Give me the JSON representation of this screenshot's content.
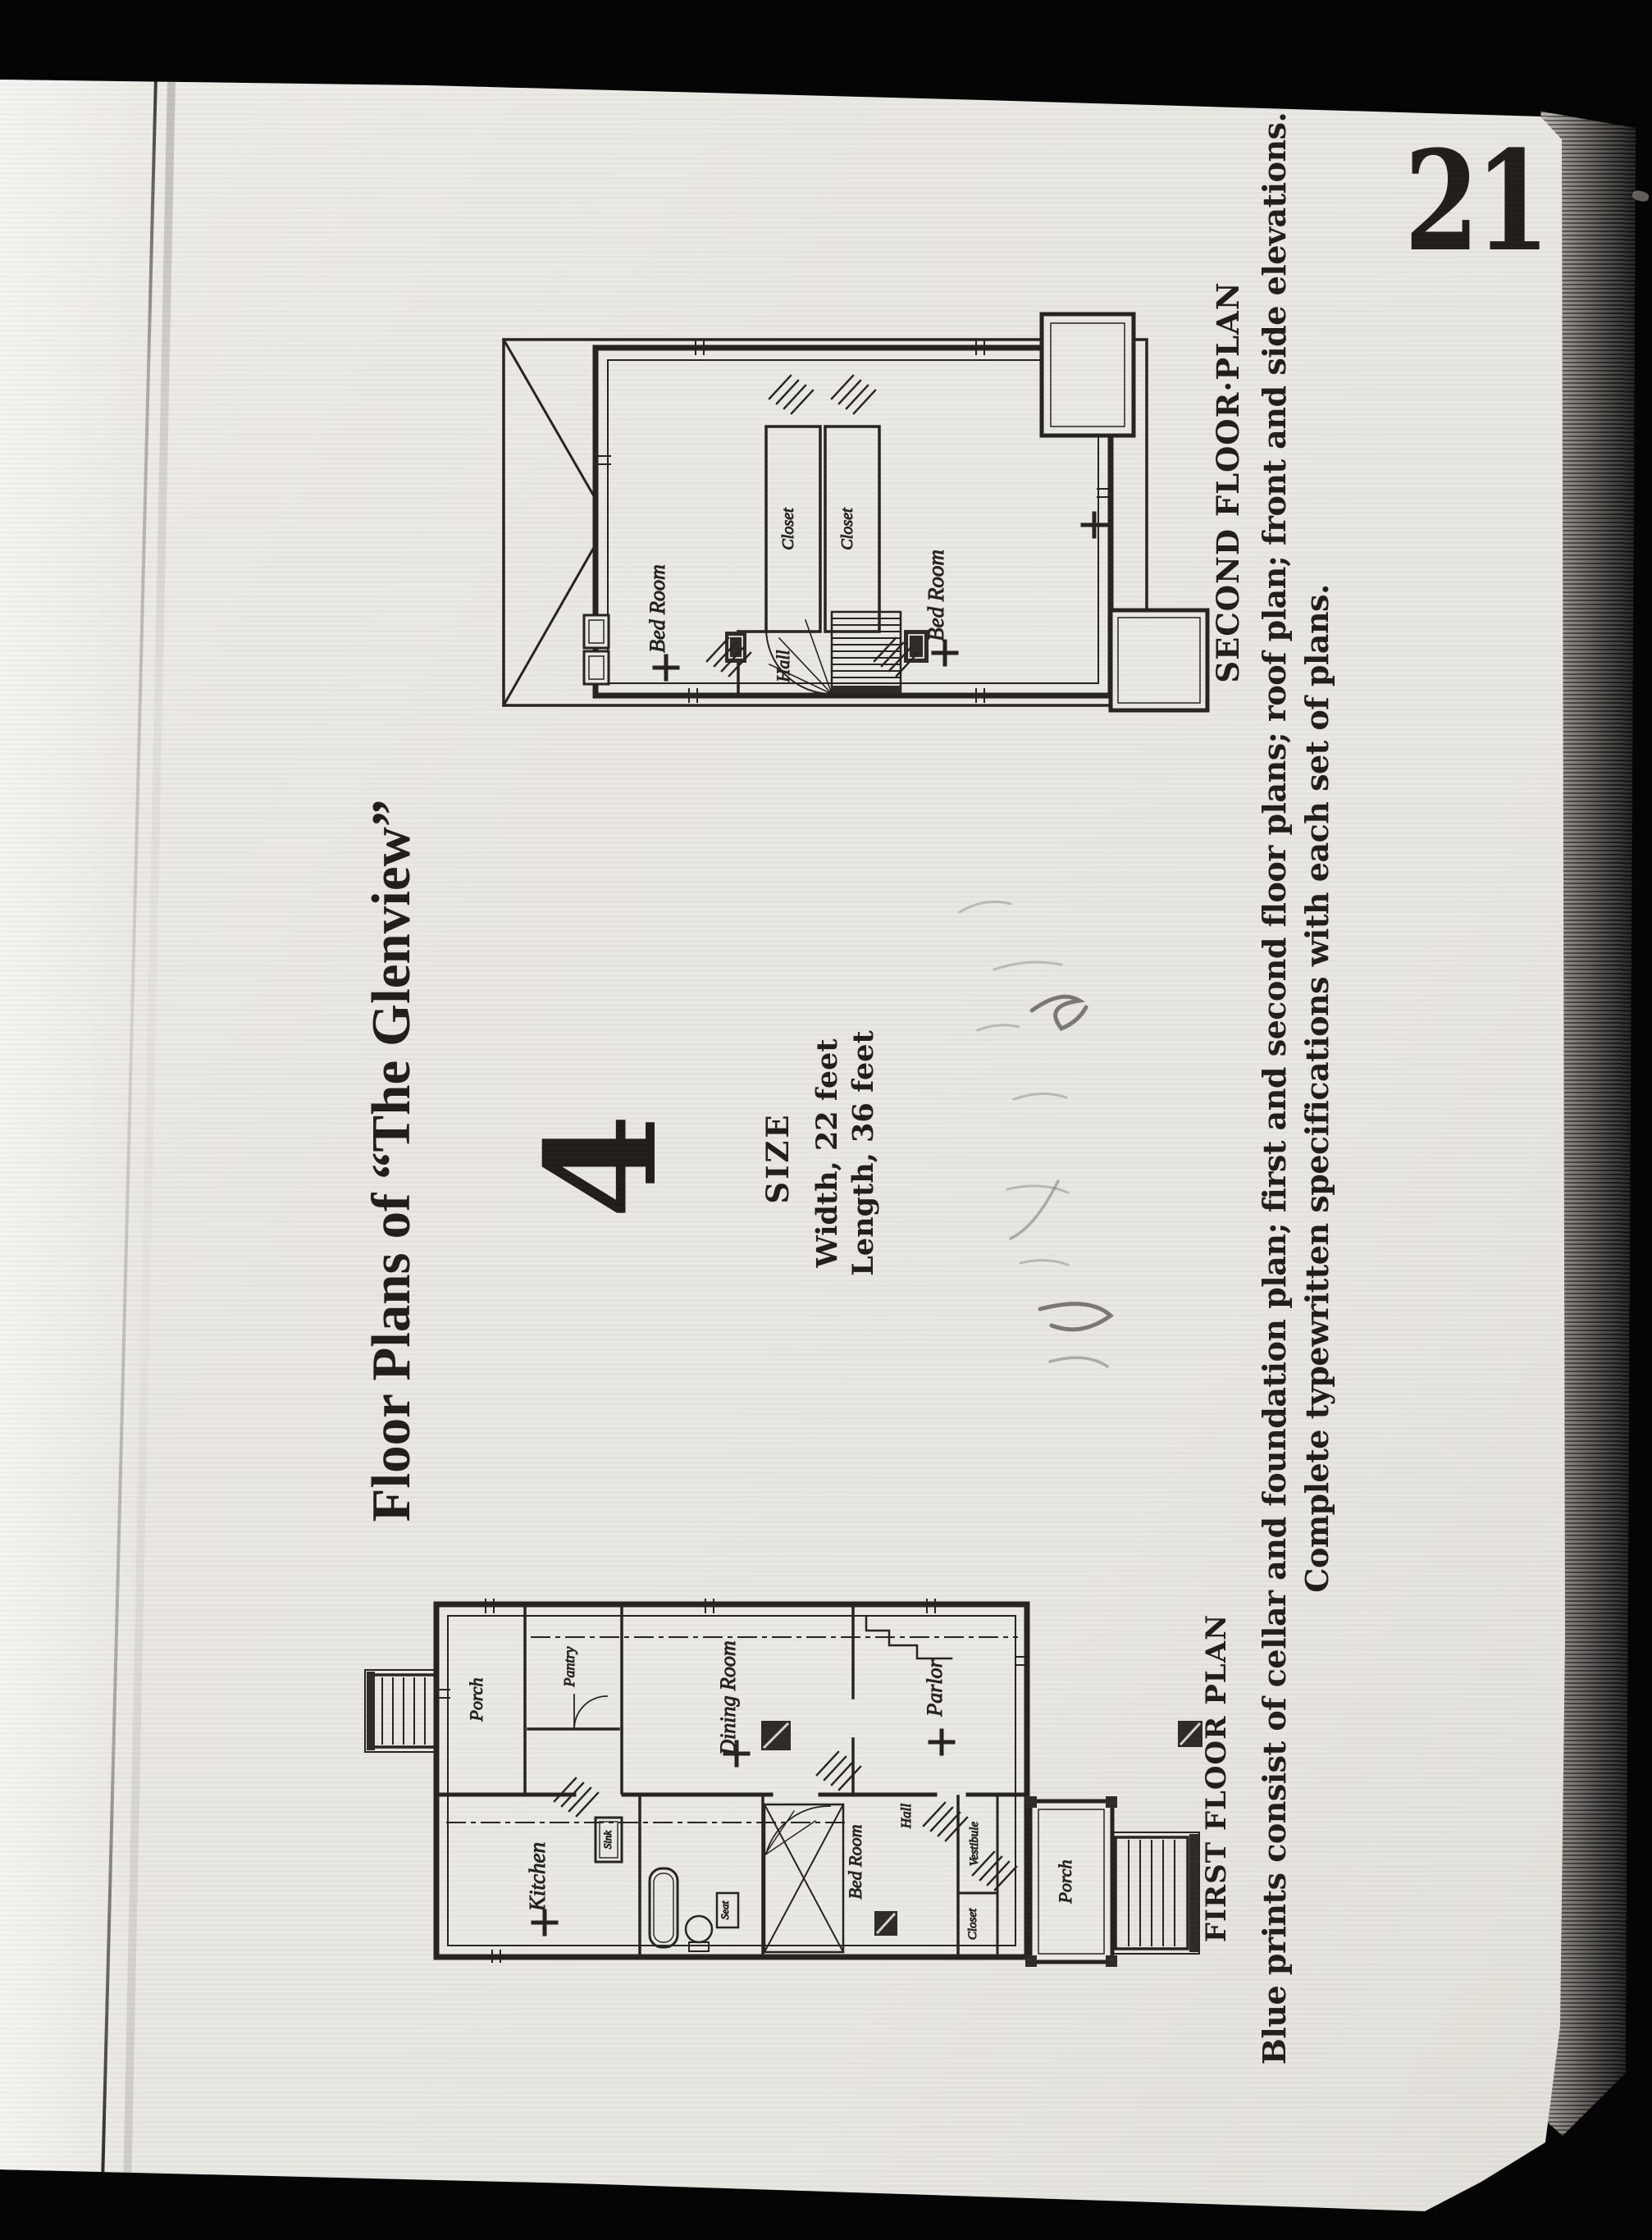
{
  "scan": {
    "page_number": "21",
    "title": "Floor Plans of “The Glenview”",
    "design_number": "4",
    "size": {
      "heading": "SIZE",
      "width": "Width, 22 feet",
      "length": "Length, 36 feet"
    },
    "captions": {
      "second_floor": "SECOND FLOOR·PLAN",
      "first_floor": "FIRST FLOOR PLAN"
    },
    "footer": {
      "line1": "Blue prints consist of cellar and foundation plan; first and second floor plans; roof plan; front and side elevations.",
      "line2": "Complete typewritten specifications with each set of plans."
    },
    "second_floor_rooms": {
      "bedroom_left": "Bed Room",
      "closet_left": "Closet",
      "closet_right": "Closet",
      "bedroom_right": "Bed Room",
      "hall": "Hall"
    },
    "first_floor_rooms": {
      "porch_rear": "Porch",
      "pantry": "Pantry",
      "dining": "Dining Room",
      "parlor": "Parlor",
      "kitchen": "Kitchen",
      "sink": "Sink",
      "seat": "Seat",
      "bedroom": "Bed Room",
      "hall": "Hall",
      "vestibule": "Vestibule",
      "closet": "Closet",
      "porch_front": "Porch"
    }
  }
}
